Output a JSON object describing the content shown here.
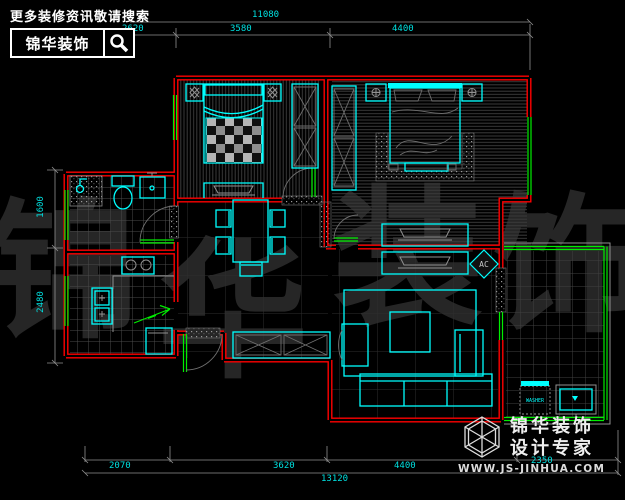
{
  "header_logo": {
    "tagline": "更多装修资讯敬请搜索",
    "brand": "锦华装饰"
  },
  "footer_logo": {
    "brand": "锦华装饰",
    "subtitle": "设计专家",
    "website": "WWW.JS-JINHUA.COM"
  },
  "dimensions": {
    "top": {
      "total": "11080",
      "segments": [
        "2620",
        "3580",
        "4400"
      ]
    },
    "bottom": {
      "total": "13120",
      "segments": [
        "2070",
        "3620",
        "4400",
        "2350"
      ]
    },
    "left": {
      "segments": [
        "1600",
        "2480"
      ]
    }
  },
  "labels": {
    "ac": "AC",
    "washer": "WASHER"
  },
  "watermark": {
    "chars": [
      "锦",
      "华",
      "装",
      "饰"
    ]
  },
  "colors": {
    "wall": "#ff0000",
    "window": "#00ee00",
    "furniture": "#00ffff",
    "dimension_text": "#00e0e0",
    "logo_text": "#ffffff"
  }
}
